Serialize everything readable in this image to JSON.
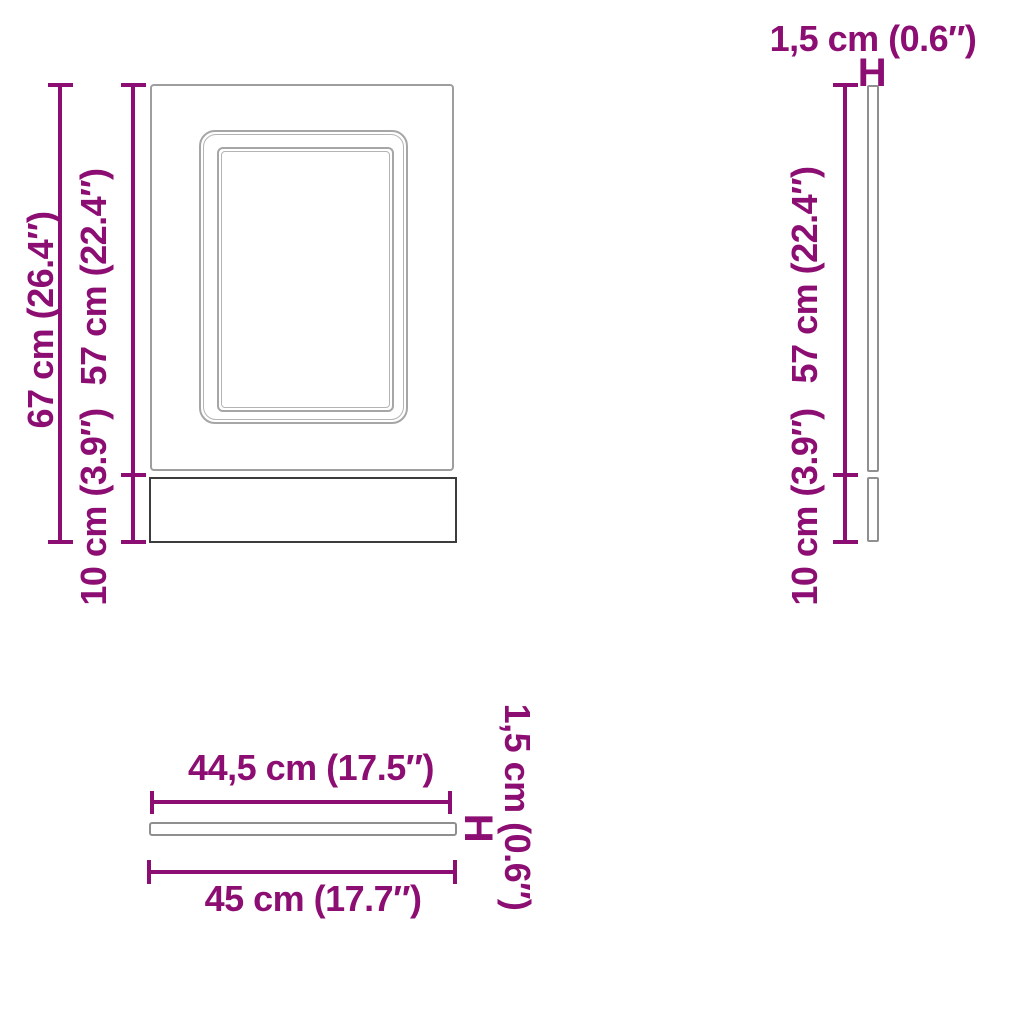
{
  "colors": {
    "accent": "#8c0e73",
    "outline_light": "#a6a6a6",
    "outline_mid": "#8f8f8f",
    "outline_dark": "#3c3c3c"
  },
  "views": {
    "front": {
      "name": "front view of panel",
      "labels": {
        "total_height": "67 cm (26.4″)",
        "door_height": "57 cm (22.4″)",
        "plinth_height": "10 cm (3.9″)"
      }
    },
    "side": {
      "name": "side view of panel",
      "labels": {
        "thickness": "1,5 cm (0.6″)",
        "thickness_marker": "H",
        "door_height": "57 cm (22.4″)",
        "plinth_height": "10 cm (3.9″)"
      }
    },
    "bottom": {
      "name": "bottom view of panel",
      "labels": {
        "panel_width": "44,5 cm (17.5″)",
        "total_width": "45 cm (17.7″)",
        "thickness": "1,5 cm (0.6″)",
        "thickness_marker": "H"
      }
    }
  },
  "measurements": {
    "total_height_cm": 67,
    "total_height_in": 26.4,
    "door_height_cm": 57,
    "door_height_in": 22.4,
    "plinth_height_cm": 10,
    "plinth_height_in": 3.9,
    "panel_width_cm": 44.5,
    "panel_width_in": 17.5,
    "total_width_cm": 45,
    "total_width_in": 17.7,
    "thickness_cm": 1.5,
    "thickness_in": 0.6
  }
}
